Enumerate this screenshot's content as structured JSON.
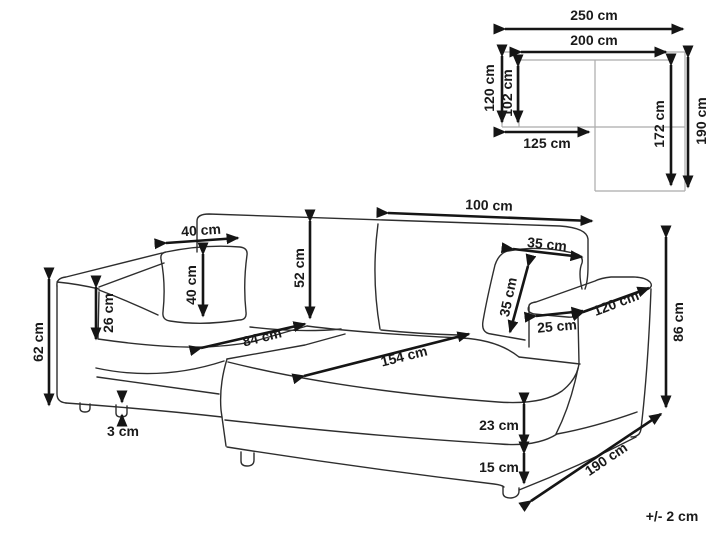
{
  "floorplan": {
    "description": "top view schematic of corner sofa",
    "dimensions": [
      {
        "id": "total-width",
        "text": "250 cm"
      },
      {
        "id": "inner-width",
        "text": "200 cm"
      },
      {
        "id": "depth-left",
        "text": "120 cm"
      },
      {
        "id": "inner-depth",
        "text": "102 cm"
      },
      {
        "id": "left-section",
        "text": "125 cm"
      },
      {
        "id": "chaise-inner",
        "text": "172 cm"
      },
      {
        "id": "chaise-total",
        "text": "190 cm"
      }
    ]
  },
  "sofa": {
    "description": "corner sofa dimension line drawing",
    "dimensions": [
      {
        "id": "back-cushion-width",
        "text": "100 cm"
      },
      {
        "id": "left-pillow-width",
        "text": "40 cm"
      },
      {
        "id": "left-pillow-height",
        "text": "40 cm"
      },
      {
        "id": "backrest-height",
        "text": "52 cm"
      },
      {
        "id": "armrest-above-seat",
        "text": "26 cm"
      },
      {
        "id": "armrest-height",
        "text": "62 cm"
      },
      {
        "id": "leg-height",
        "text": "3 cm"
      },
      {
        "id": "right-pillow-width",
        "text": "35 cm"
      },
      {
        "id": "right-pillow-height",
        "text": "35 cm"
      },
      {
        "id": "armrest-width",
        "text": "25 cm"
      },
      {
        "id": "armrest-length",
        "text": "120 cm"
      },
      {
        "id": "overall-height",
        "text": "86 cm"
      },
      {
        "id": "left-seat-width",
        "text": "84 cm"
      },
      {
        "id": "chaise-seat-length",
        "text": "154 cm"
      },
      {
        "id": "seat-edge-height",
        "text": "23 cm"
      },
      {
        "id": "base-height",
        "text": "15 cm"
      },
      {
        "id": "chaise-length",
        "text": "190 cm"
      }
    ],
    "tolerance": "+/- 2 cm"
  }
}
